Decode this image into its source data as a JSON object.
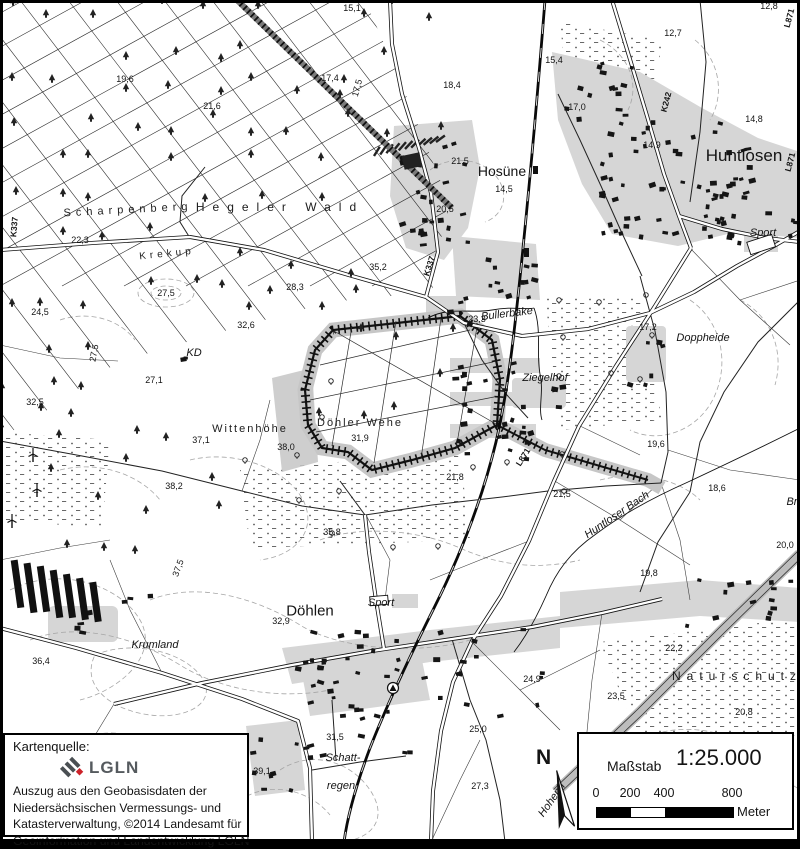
{
  "attribution": {
    "source_label": "Kartenquelle:",
    "logo_text": "LGLN",
    "lines": [
      "Auszug aus den Geobasisdaten der",
      "Niedersächsischen Vermessungs- und",
      "Katasterverwaltung, ©2014 Landesamt für",
      "Geoinformation und Landentwicklung LGLN"
    ]
  },
  "scale_panel": {
    "label": "Maßstab",
    "ratio": "1:25.000",
    "bar_ticks": [
      "0",
      "200",
      "400",
      "800"
    ],
    "unit": "Meter"
  },
  "compass": {
    "north_label": "N"
  },
  "colors": {
    "paper": "#ffffff",
    "ink": "#141414",
    "builtup": "#d6d6d6",
    "halo": "#c6c6c6",
    "contour": "#a6a6a6",
    "logoRed": "#cc2229",
    "logoGray": "#555a5e"
  },
  "map_labels": {
    "places": [
      {
        "t": "Hosüne",
        "x": 502,
        "y": 171,
        "fs": 14
      },
      {
        "t": "Huntlosen",
        "x": 744,
        "y": 156,
        "fs": 17
      },
      {
        "t": "Döhlen",
        "x": 310,
        "y": 611,
        "fs": 15
      }
    ],
    "areas": [
      {
        "t": "Scharpenberg",
        "x": 128,
        "y": 210,
        "ls": 5,
        "rot": -3,
        "fs": 11
      },
      {
        "t": "Hegeler Wald",
        "x": 280,
        "y": 207,
        "ls": 8,
        "fs": 12
      },
      {
        "t": "Krekup",
        "x": 167,
        "y": 254,
        "ls": 4,
        "rot": -6,
        "fs": 10
      },
      {
        "t": "Wittenhöhe",
        "x": 250,
        "y": 429,
        "ls": 2,
        "fs": 11
      },
      {
        "t": "Döhler Wehe",
        "x": 360,
        "y": 423,
        "ls": 2,
        "fs": 11
      },
      {
        "t": "Naturschutz",
        "x": 737,
        "y": 676,
        "ls": 6,
        "fs": 12
      }
    ],
    "names_italic": [
      {
        "t": "Bullerbäke",
        "x": 507,
        "y": 314,
        "rot": -7
      },
      {
        "t": "Ziegelhof",
        "x": 545,
        "y": 378
      },
      {
        "t": "Doppheide",
        "x": 703,
        "y": 338
      },
      {
        "t": "Huntloser Bach",
        "x": 617,
        "y": 515,
        "rot": -34
      },
      {
        "t": "Krumland",
        "x": 155,
        "y": 645
      },
      {
        "t": "Sport",
        "x": 763,
        "y": 233
      },
      {
        "t": "Sport",
        "x": 381,
        "y": 603
      },
      {
        "t": "Schatt-",
        "x": 343,
        "y": 758
      },
      {
        "t": "regen",
        "x": 341,
        "y": 786
      },
      {
        "t": "KD",
        "x": 194,
        "y": 353
      },
      {
        "t": "Hohenh",
        "x": 552,
        "y": 800,
        "rot": -55
      },
      {
        "t": "Bro",
        "x": 795,
        "y": 502
      }
    ],
    "roads": [
      {
        "t": "K337",
        "x": 14,
        "y": 227,
        "rot": -85
      },
      {
        "t": "K337",
        "x": 429,
        "y": 266,
        "rot": -72
      },
      {
        "t": "K242",
        "x": 666,
        "y": 102,
        "rot": -75
      },
      {
        "t": "L871",
        "x": 789,
        "y": 18,
        "rot": -75
      },
      {
        "t": "L871",
        "x": 790,
        "y": 162,
        "rot": -75
      },
      {
        "t": "L871",
        "x": 523,
        "y": 457,
        "rot": -58
      }
    ],
    "spot_heights": [
      {
        "t": "15,1",
        "x": 352,
        "y": 8
      },
      {
        "t": "17,4",
        "x": 330,
        "y": 78
      },
      {
        "t": "17,5",
        "x": 357,
        "y": 88,
        "rot": -75
      },
      {
        "t": "19,6",
        "x": 125,
        "y": 79
      },
      {
        "t": "21,6",
        "x": 212,
        "y": 106
      },
      {
        "t": "18,4",
        "x": 452,
        "y": 85
      },
      {
        "t": "15,4",
        "x": 554,
        "y": 60
      },
      {
        "t": "12,7",
        "x": 673,
        "y": 33
      },
      {
        "t": "12,8",
        "x": 769,
        "y": 6
      },
      {
        "t": "17,0",
        "x": 577,
        "y": 107
      },
      {
        "t": "14,8",
        "x": 754,
        "y": 119
      },
      {
        "t": "14,9",
        "x": 652,
        "y": 145
      },
      {
        "t": "21,5",
        "x": 460,
        "y": 161
      },
      {
        "t": "14,5",
        "x": 504,
        "y": 189
      },
      {
        "t": "20,5",
        "x": 445,
        "y": 209
      },
      {
        "t": "22,3",
        "x": 80,
        "y": 240
      },
      {
        "t": "24,5",
        "x": 40,
        "y": 312
      },
      {
        "t": "27,5",
        "x": 166,
        "y": 293
      },
      {
        "t": "27,5",
        "x": 94,
        "y": 353,
        "rot": -80
      },
      {
        "t": "28,3",
        "x": 295,
        "y": 287
      },
      {
        "t": "35,2",
        "x": 378,
        "y": 267
      },
      {
        "t": "32,6",
        "x": 246,
        "y": 325
      },
      {
        "t": "32,5",
        "x": 35,
        "y": 402
      },
      {
        "t": "27,1",
        "x": 154,
        "y": 380
      },
      {
        "t": "37,1",
        "x": 201,
        "y": 440
      },
      {
        "t": "38,0",
        "x": 286,
        "y": 447
      },
      {
        "t": "31,9",
        "x": 360,
        "y": 438
      },
      {
        "t": "38,2",
        "x": 174,
        "y": 486
      },
      {
        "t": "37,5",
        "x": 178,
        "y": 568,
        "rot": -70
      },
      {
        "t": "36,4",
        "x": 41,
        "y": 661
      },
      {
        "t": "35,8",
        "x": 332,
        "y": 532
      },
      {
        "t": "21,8",
        "x": 455,
        "y": 477
      },
      {
        "t": "21,5",
        "x": 562,
        "y": 494
      },
      {
        "t": "19,6",
        "x": 656,
        "y": 444
      },
      {
        "t": "18,6",
        "x": 717,
        "y": 488
      },
      {
        "t": "20,0",
        "x": 785,
        "y": 545
      },
      {
        "t": "19,8",
        "x": 649,
        "y": 573
      },
      {
        "t": "22,2",
        "x": 674,
        "y": 648
      },
      {
        "t": "23,5",
        "x": 616,
        "y": 696
      },
      {
        "t": "24,9",
        "x": 532,
        "y": 679
      },
      {
        "t": "25,0",
        "x": 478,
        "y": 729
      },
      {
        "t": "27,3",
        "x": 480,
        "y": 786
      },
      {
        "t": "31,5",
        "x": 335,
        "y": 737
      },
      {
        "t": "32,9",
        "x": 281,
        "y": 621
      },
      {
        "t": "39,1",
        "x": 262,
        "y": 771
      },
      {
        "t": "17,2",
        "x": 648,
        "y": 327
      },
      {
        "t": "23,3",
        "x": 477,
        "y": 319
      },
      {
        "t": "20,8",
        "x": 744,
        "y": 712
      }
    ]
  }
}
